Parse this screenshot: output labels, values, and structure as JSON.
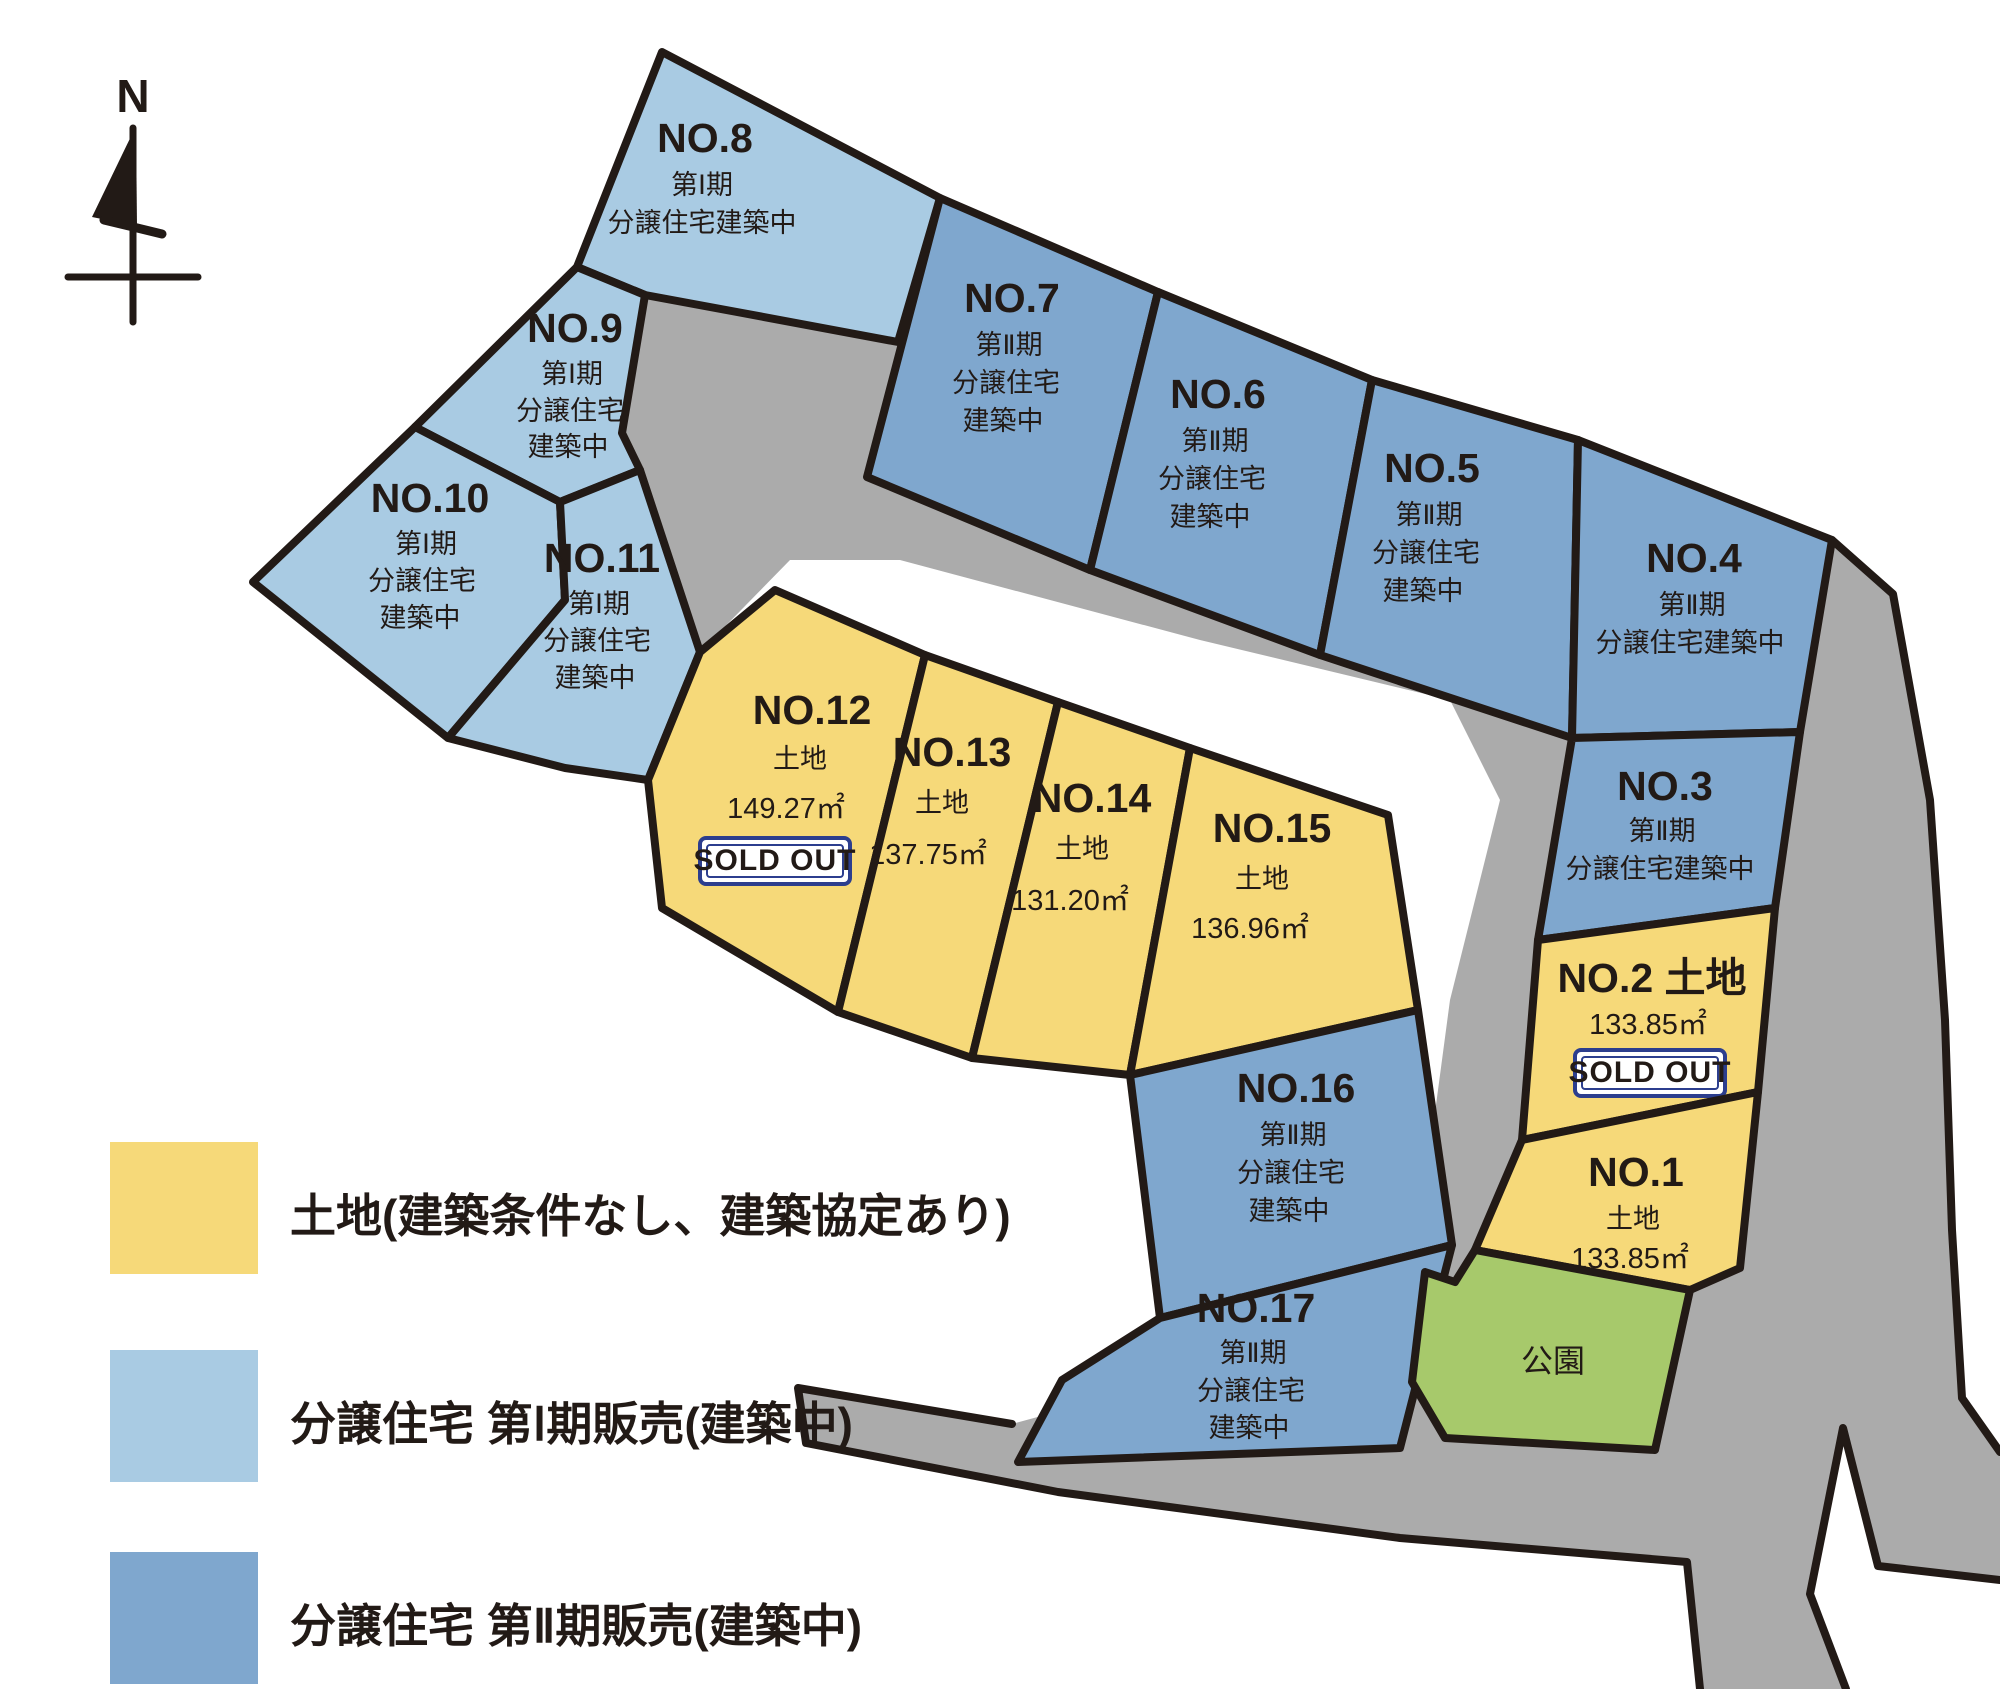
{
  "compass": {
    "label": "N"
  },
  "sold_out_label": "SOLD OUT",
  "park": {
    "label": "公園"
  },
  "colors": {
    "land": "#F6D979",
    "phase1": "#A9CBE3",
    "phase2": "#7FA7CE",
    "park": "#A7C96B",
    "road": "#ABABAB",
    "outline": "#221A16",
    "badge_border": "#2C3E8E"
  },
  "legend": [
    {
      "label": "土地(建築条件なし、建築協定あり)",
      "color_key": "land"
    },
    {
      "label": "分譲住宅 第Ⅰ期販売(建築中)",
      "color_key": "phase1"
    },
    {
      "label": "分譲住宅 第Ⅱ期販売(建築中)",
      "color_key": "phase2"
    }
  ],
  "lots": [
    {
      "name": "NO.1",
      "category": "land",
      "lines": [
        "土地",
        "133.85㎡"
      ],
      "sold_out": false
    },
    {
      "name": "NO.2 土地",
      "category": "land",
      "lines": [
        "133.85㎡"
      ],
      "sold_out": true
    },
    {
      "name": "NO.3",
      "category": "phase2",
      "lines": [
        "第Ⅱ期",
        "分譲住宅建築中"
      ],
      "sold_out": false
    },
    {
      "name": "NO.4",
      "category": "phase2",
      "lines": [
        "第Ⅱ期",
        "分譲住宅建築中"
      ],
      "sold_out": false
    },
    {
      "name": "NO.5",
      "category": "phase2",
      "lines": [
        "第Ⅱ期",
        "分譲住宅",
        "建築中"
      ],
      "sold_out": false
    },
    {
      "name": "NO.6",
      "category": "phase2",
      "lines": [
        "第Ⅱ期",
        "分譲住宅",
        "建築中"
      ],
      "sold_out": false
    },
    {
      "name": "NO.7",
      "category": "phase2",
      "lines": [
        "第Ⅱ期",
        "分譲住宅",
        "建築中"
      ],
      "sold_out": false
    },
    {
      "name": "NO.8",
      "category": "phase1",
      "lines": [
        "第Ⅰ期",
        "分譲住宅建築中"
      ],
      "sold_out": false
    },
    {
      "name": "NO.9",
      "category": "phase1",
      "lines": [
        "第Ⅰ期",
        "分譲住宅",
        "建築中"
      ],
      "sold_out": false
    },
    {
      "name": "NO.10",
      "category": "phase1",
      "lines": [
        "第Ⅰ期",
        "分譲住宅",
        "建築中"
      ],
      "sold_out": false
    },
    {
      "name": "NO.11",
      "category": "phase1",
      "lines": [
        "第Ⅰ期",
        "分譲住宅",
        "建築中"
      ],
      "sold_out": false
    },
    {
      "name": "NO.12",
      "category": "land",
      "lines": [
        "土地",
        "149.27㎡"
      ],
      "sold_out": true
    },
    {
      "name": "NO.13",
      "category": "land",
      "lines": [
        "土地",
        "137.75㎡"
      ],
      "sold_out": false
    },
    {
      "name": "NO.14",
      "category": "land",
      "lines": [
        "土地",
        "131.20㎡"
      ],
      "sold_out": false
    },
    {
      "name": "NO.15",
      "category": "land",
      "lines": [
        "土地",
        "136.96㎡"
      ],
      "sold_out": false
    },
    {
      "name": "NO.16",
      "category": "phase2",
      "lines": [
        "第Ⅱ期",
        "分譲住宅",
        "建築中"
      ],
      "sold_out": false
    },
    {
      "name": "NO.17",
      "category": "phase2",
      "lines": [
        "第Ⅱ期",
        "分譲住宅",
        "建築中"
      ],
      "sold_out": false
    }
  ]
}
